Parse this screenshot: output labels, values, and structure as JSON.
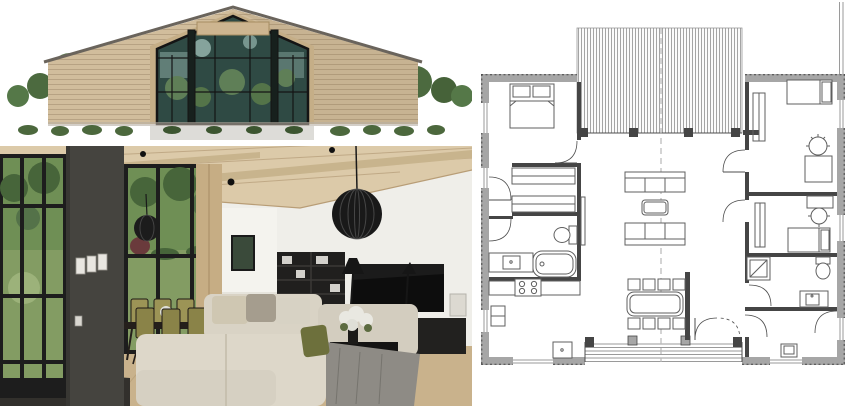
{
  "page": {
    "background": "#ffffff"
  },
  "palette": {
    "page_bg": "#ffffff",
    "plan_wall": "#a6a6a6",
    "plan_wall_dark": "#454545",
    "plan_line": "#4d4d4d",
    "plan_line_light": "#9a9a9a",
    "plan_fixture": "#5f5f5f",
    "plan_dash": "#b8b8b8",
    "ext_wood": "#d1bd9c",
    "ext_roof": "#6a645c",
    "ext_glass": "#2f4a44",
    "ext_glass_light": "#bfe0d7",
    "ext_tree": "#5a7c4b",
    "ext_tree_dark": "#415e36",
    "ext_bush": "#4c683d",
    "ext_walk": "#dddcd8",
    "ext_shadow": "#b5aea1",
    "int_ceiling": "#dccaa9",
    "int_beam": "#c8b48d",
    "int_wall": "#efeee9",
    "int_window": "#1d1d1d",
    "int_garden": "#6f8f55",
    "int_garden_dark": "#47653a",
    "int_lawn": "#839c63",
    "int_column": "#45443f",
    "int_floor": "#c9b28c",
    "int_floor_line": "#b39b74",
    "int_sofa": "#d9d3c5",
    "int_tv": "#0d0d0d",
    "int_shelf": "#201f1e",
    "int_chair": "#9c9456",
    "int_blanket": "#8e8b85",
    "int_olive": "#6d703c"
  },
  "panels": {
    "exterior": {
      "alt": "Modern single-storey house exterior with light wood siding, gable roof and full-height glazed gable entrance reflecting trees, low bushes in front"
    },
    "interior": {
      "alt": "Open living room with wood plank ceiling, tall black-framed garden windows, charcoal column, dining set with olive chairs, black sphere pendant, shelving, wall TV and cream sectional sofa"
    },
    "plan": {
      "alt": "Single-storey floor plan with covered porch roof, entry deck with steps, open living-dining-kitchen, three bedrooms, two bathrooms and utility room"
    }
  },
  "floor_plan": {
    "rooms": [
      "bedroom-1",
      "walk-in-closet",
      "bathroom-1",
      "kitchen",
      "living-room",
      "dining-area",
      "entry-hall",
      "bedroom-2",
      "bedroom-3",
      "bathroom-2",
      "utility-room"
    ],
    "features": [
      "covered-porch-roof-hatch",
      "entry-deck-steps",
      "double-entry-door",
      "section-centerline"
    ],
    "fixtures": {
      "double_beds": 1,
      "single_beds": 2,
      "sofas": 2,
      "coffee_tables": 1,
      "dining_chairs": 8,
      "desk_chairs": 2,
      "toilets": 2,
      "bathtubs": 1,
      "showers": 1,
      "sinks": 4,
      "stove_burners": 4
    }
  }
}
